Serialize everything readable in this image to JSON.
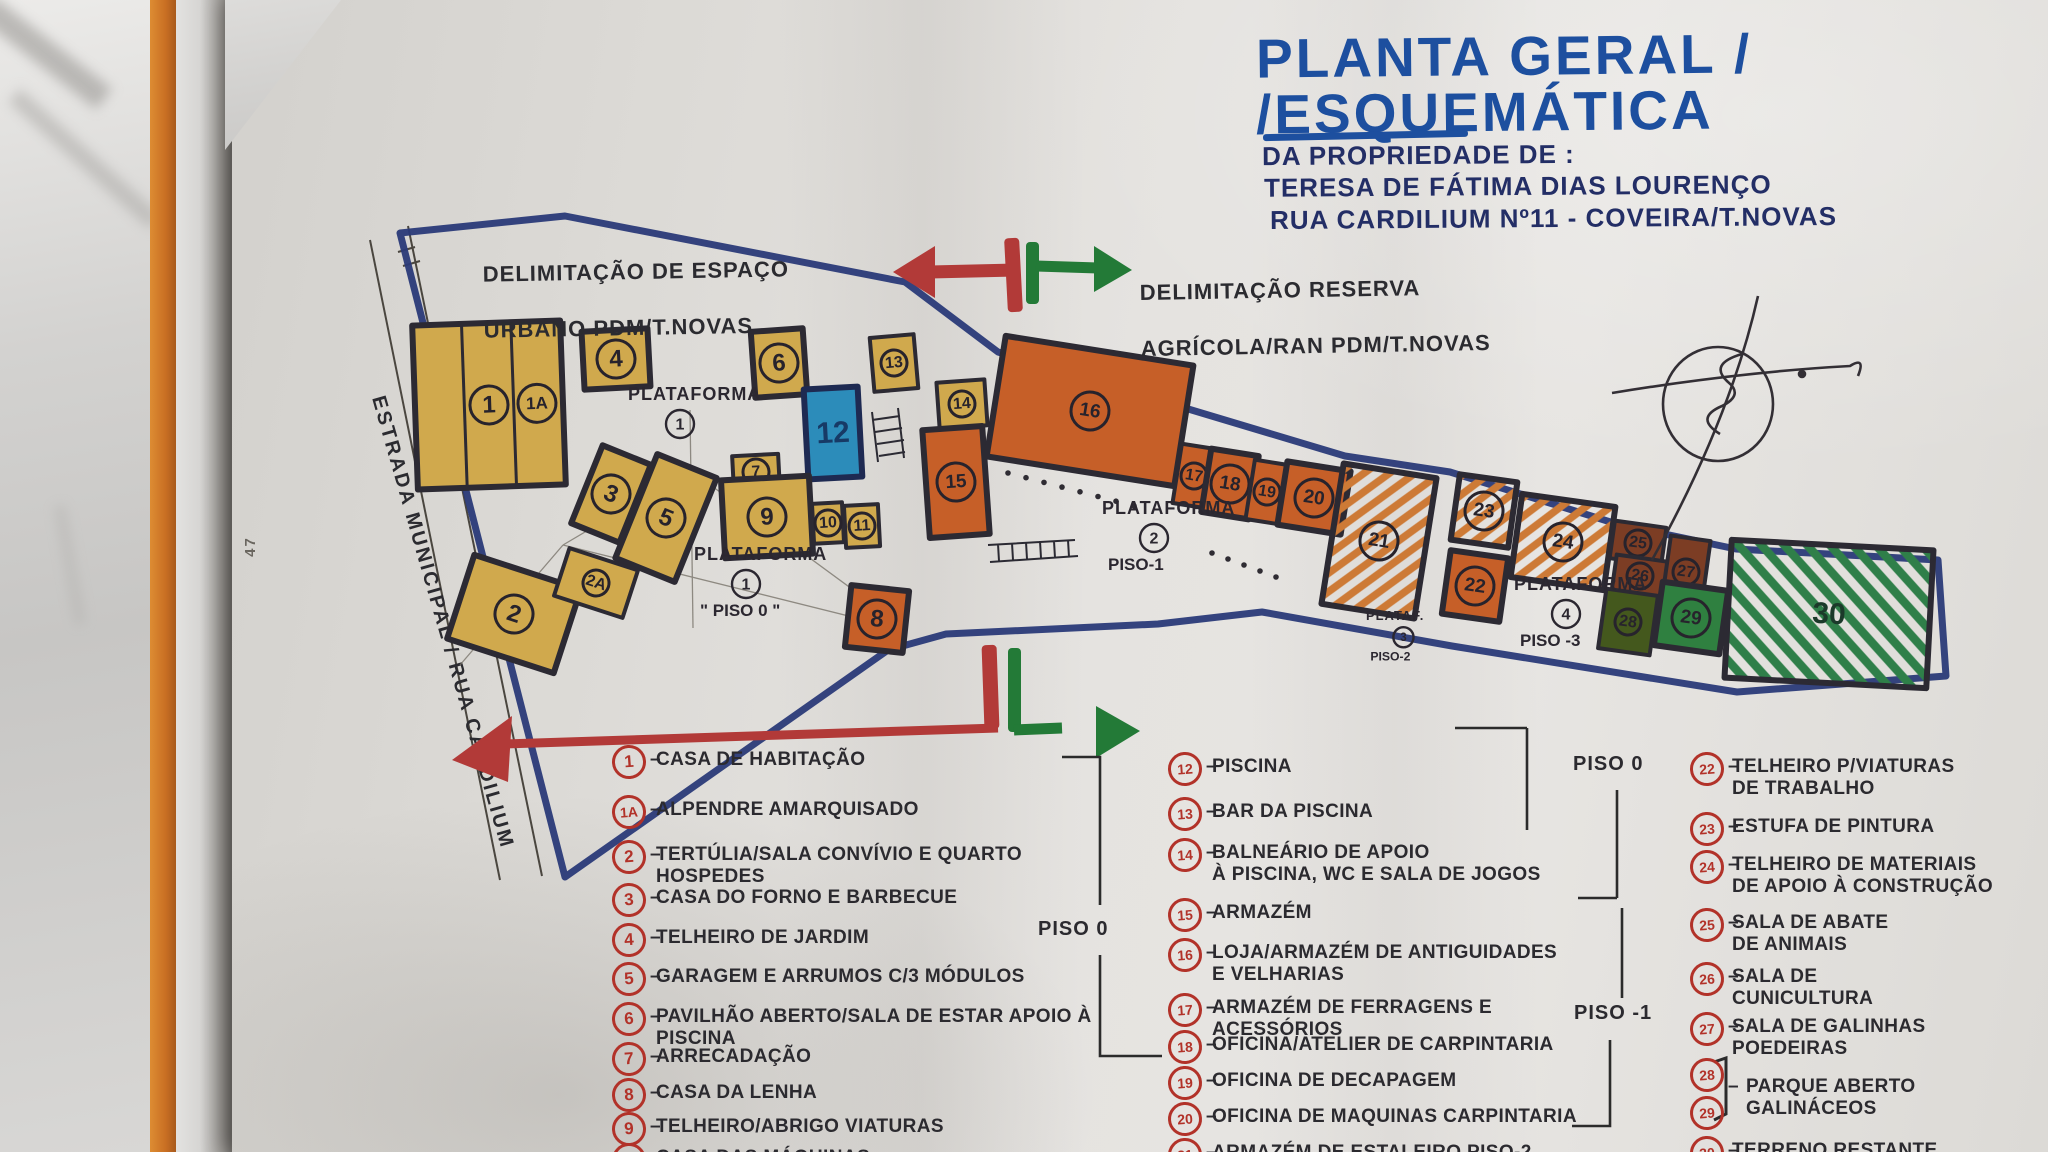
{
  "title": {
    "line1": "PLANTA GERAL /",
    "line2": "/ESQUEMÁTICA",
    "sub1": "DA PROPRIEDADE DE :",
    "sub2": "TERESA DE FÁTIMA DIAS LOURENÇO",
    "sub3": "RUA CARDILIUM Nº11 - COVEIRA/T.NOVAS"
  },
  "annotations": {
    "urban_line1": "DELIMITAÇÃO DE ESPAÇO",
    "urban_line2": "URBANO  PDM/T.NOVAS",
    "reserve_line1": "DELIMITAÇÃO RESERVA",
    "reserve_line2": "AGRÍCOLA/RAN PDM/T.NOVAS",
    "road": "ESTRADA  MUNICIPAL / RUA CARDILIUM",
    "page_number": "47"
  },
  "colors": {
    "title_blue": "#1d4f9f",
    "sub_navy": "#232e66",
    "ink": "#2b2a2f",
    "legend_red": "#b23229",
    "boundary_blue": "#2a3a78",
    "arrow_red": "#b23a38",
    "arrow_green": "#237a37",
    "bldg_yellow": "#d0a94d",
    "bldg_orange": "#c65f28",
    "bldg_brown": "#7c3d24",
    "bldg_green": "#2f8040",
    "bldg_green_dark": "#44581d",
    "pool_blue": "#2c8cba",
    "hatch_orange": "#cd7a36",
    "hatch_green": "#2f7f49"
  },
  "plan": {
    "platform_labels": [
      {
        "text": "PLATAFORMA",
        "num": "1",
        "piso": "",
        "x": 628,
        "y": 400
      },
      {
        "text": "PLATAFORMA",
        "num": "1",
        "piso": "\" PISO 0 \"",
        "x": 694,
        "y": 560
      },
      {
        "text": "PLATAFORMA",
        "num": "2",
        "piso": "PISO-1",
        "x": 1102,
        "y": 514
      },
      {
        "text": "PLATAF.",
        "num": "3",
        "piso": "PISO-2",
        "x": 1366,
        "y": 620,
        "small": true
      },
      {
        "text": "PLATAFORMA",
        "num": "4",
        "piso": "PISO -3",
        "x": 1514,
        "y": 590
      }
    ],
    "buildings": [
      {
        "num": "1",
        "x": 415,
        "y": 323,
        "w": 148,
        "h": 164,
        "rot": -2,
        "type": "yellow",
        "stripes": 3,
        "num2": "1A"
      },
      {
        "num": "4",
        "x": 583,
        "y": 330,
        "w": 66,
        "h": 58,
        "rot": -3,
        "type": "yellow"
      },
      {
        "num": "6",
        "x": 753,
        "y": 330,
        "w": 52,
        "h": 66,
        "rot": -4,
        "type": "yellow"
      },
      {
        "num": "13",
        "x": 872,
        "y": 336,
        "w": 44,
        "h": 54,
        "rot": -5,
        "type": "yellow",
        "small": true
      },
      {
        "num": "12",
        "x": 806,
        "y": 388,
        "w": 54,
        "h": 90,
        "rot": -3,
        "type": "pool",
        "plain": true
      },
      {
        "num": "3",
        "x": 585,
        "y": 452,
        "w": 52,
        "h": 84,
        "rot": 22,
        "type": "yellow"
      },
      {
        "num": "5",
        "x": 634,
        "y": 462,
        "w": 64,
        "h": 112,
        "rot": 22,
        "type": "yellow"
      },
      {
        "num": "2",
        "x": 458,
        "y": 570,
        "w": 112,
        "h": 88,
        "rot": 18,
        "type": "yellow"
      },
      {
        "num": "2A",
        "x": 560,
        "y": 558,
        "w": 72,
        "h": 50,
        "rot": 18,
        "type": "yellow",
        "small": true
      },
      {
        "num": "7",
        "x": 733,
        "y": 455,
        "w": 46,
        "h": 34,
        "rot": -3,
        "type": "yellow",
        "small": true
      },
      {
        "num": "9",
        "x": 723,
        "y": 478,
        "w": 88,
        "h": 78,
        "rot": -3,
        "type": "yellow"
      },
      {
        "num": "10",
        "x": 813,
        "y": 503,
        "w": 30,
        "h": 40,
        "rot": -3,
        "type": "yellow",
        "small": true
      },
      {
        "num": "11",
        "x": 845,
        "y": 505,
        "w": 34,
        "h": 42,
        "rot": -3,
        "type": "yellow",
        "small": true
      },
      {
        "num": "8",
        "x": 848,
        "y": 588,
        "w": 58,
        "h": 62,
        "rot": 6,
        "type": "orange"
      },
      {
        "num": "14",
        "x": 938,
        "y": 381,
        "w": 48,
        "h": 46,
        "rot": -4,
        "type": "yellow",
        "small": true
      },
      {
        "num": "15",
        "x": 926,
        "y": 428,
        "w": 60,
        "h": 108,
        "rot": -4,
        "type": "orange"
      },
      {
        "num": "16",
        "x": 995,
        "y": 350,
        "w": 190,
        "h": 122,
        "rot": 9,
        "type": "orange"
      },
      {
        "num": "17",
        "x": 1177,
        "y": 446,
        "w": 34,
        "h": 60,
        "rot": 9,
        "type": "orange",
        "small": true
      },
      {
        "num": "18",
        "x": 1206,
        "y": 452,
        "w": 48,
        "h": 64,
        "rot": 9,
        "type": "orange"
      },
      {
        "num": "19",
        "x": 1250,
        "y": 462,
        "w": 34,
        "h": 60,
        "rot": 9,
        "type": "orange",
        "small": true
      },
      {
        "num": "20",
        "x": 1282,
        "y": 466,
        "w": 64,
        "h": 64,
        "rot": 9,
        "type": "orange"
      },
      {
        "num": "21",
        "x": 1332,
        "y": 470,
        "w": 94,
        "h": 142,
        "rot": 9,
        "type": "orange-hatch"
      },
      {
        "num": "23",
        "x": 1455,
        "y": 478,
        "w": 58,
        "h": 66,
        "rot": 8,
        "type": "orange-hatch"
      },
      {
        "num": "24",
        "x": 1516,
        "y": 500,
        "w": 94,
        "h": 84,
        "rot": 8,
        "type": "orange-hatch"
      },
      {
        "num": "22",
        "x": 1446,
        "y": 554,
        "w": 58,
        "h": 64,
        "rot": 8,
        "type": "orange"
      },
      {
        "num": "25",
        "x": 1612,
        "y": 524,
        "w": 52,
        "h": 38,
        "rot": 8,
        "type": "brown",
        "small": true
      },
      {
        "num": "26",
        "x": 1614,
        "y": 558,
        "w": 52,
        "h": 36,
        "rot": 8,
        "type": "brown",
        "small": true
      },
      {
        "num": "27",
        "x": 1666,
        "y": 538,
        "w": 40,
        "h": 68,
        "rot": 8,
        "type": "brown",
        "small": true
      },
      {
        "num": "28",
        "x": 1602,
        "y": 592,
        "w": 52,
        "h": 60,
        "rot": 8,
        "type": "green-dark",
        "small": true
      },
      {
        "num": "29",
        "x": 1658,
        "y": 586,
        "w": 66,
        "h": 64,
        "rot": 8,
        "type": "green"
      },
      {
        "num": "30",
        "x": 1728,
        "y": 545,
        "w": 202,
        "h": 138,
        "rot": 3,
        "type": "green-hatch",
        "plain": true
      }
    ]
  },
  "legend": {
    "piso_markers": [
      {
        "text": "PISO 0",
        "x": 1038,
        "y": 918
      },
      {
        "text": "PISO 0",
        "x": 1573,
        "y": 753
      },
      {
        "text": "PISO -1",
        "x": 1574,
        "y": 1002
      }
    ],
    "columns": [
      {
        "cx": 612,
        "tx": 656,
        "items": [
          {
            "num": "1",
            "y": 745,
            "text": "CASA DE HABITAÇÃO"
          },
          {
            "num": "1A",
            "y": 795,
            "text": "ALPENDRE AMARQUISADO"
          },
          {
            "num": "2",
            "y": 840,
            "text": "TERTÚLIA/SALA CONVÍVIO E QUARTO HOSPEDES"
          },
          {
            "num": "3",
            "y": 883,
            "text": "CASA DO FORNO E BARBECUE"
          },
          {
            "num": "4",
            "y": 923,
            "text": "TELHEIRO DE JARDIM"
          },
          {
            "num": "5",
            "y": 962,
            "text": "GARAGEM E ARRUMOS C/3 MÓDULOS"
          },
          {
            "num": "6",
            "y": 1002,
            "text": "PAVILHÃO ABERTO/SALA DE ESTAR APOIO À PISCINA"
          },
          {
            "num": "7",
            "y": 1042,
            "text": "ARRECADAÇÃO"
          },
          {
            "num": "8",
            "y": 1078,
            "text": "CASA DA LENHA"
          },
          {
            "num": "9",
            "y": 1112,
            "text": "TELHEIRO/ABRIGO VIATURAS"
          },
          {
            "num": "10",
            "y": 1143,
            "text": "CASA DAS MÁQUINAS"
          }
        ]
      },
      {
        "cx": 1168,
        "tx": 1212,
        "items": [
          {
            "num": "12",
            "y": 752,
            "text": "PISCINA"
          },
          {
            "num": "13",
            "y": 797,
            "text": "BAR DA PISCINA"
          },
          {
            "num": "14",
            "y": 838,
            "text": "BALNEÁRIO DE APOIO\nÀ PISCINA, WC E SALA DE JOGOS"
          },
          {
            "num": "15",
            "y": 898,
            "text": "ARMAZÉM"
          },
          {
            "num": "16",
            "y": 938,
            "text": "LOJA/ARMAZÉM DE ANTIGUIDADES\nE VELHARIAS"
          },
          {
            "num": "17",
            "y": 993,
            "text": "ARMAZÉM DE FERRAGENS E ACESSÓRIOS"
          },
          {
            "num": "18",
            "y": 1030,
            "text": "OFICINA/ATELIER DE CARPINTARIA"
          },
          {
            "num": "19",
            "y": 1066,
            "text": "OFICINA DE DECAPAGEM"
          },
          {
            "num": "20",
            "y": 1102,
            "text": "OFICINA DE MAQUINAS CARPINTARIA"
          },
          {
            "num": "21",
            "y": 1138,
            "text": "ARMAZÉM DE ESTALEIRO PISO-2"
          }
        ]
      },
      {
        "cx": 1690,
        "tx": 1732,
        "items": [
          {
            "num": "22",
            "y": 752,
            "text": "TELHEIRO P/VIATURAS\nDE TRABALHO"
          },
          {
            "num": "23",
            "y": 812,
            "text": "ESTUFA DE PINTURA"
          },
          {
            "num": "24",
            "y": 850,
            "text": "TELHEIRO DE MATERIAIS\nDE APOIO À CONSTRUÇÃO"
          },
          {
            "num": "25",
            "y": 908,
            "text": "SALA DE ABATE\nDE ANIMAIS"
          },
          {
            "num": "26",
            "y": 962,
            "text": "SALA DE\nCUNICULTURA"
          },
          {
            "num": "27",
            "y": 1012,
            "text": "SALA DE GALINHAS\nPOEDEIRAS"
          },
          {
            "num": "28",
            "y": 1058,
            "text": ""
          },
          {
            "num": "29",
            "y": 1096,
            "text": "PARQUE ABERTO\nGALINÁCEOS",
            "bracket": true
          },
          {
            "num": "30",
            "y": 1136,
            "text": "TERRENO RESTANTE"
          }
        ]
      }
    ]
  }
}
